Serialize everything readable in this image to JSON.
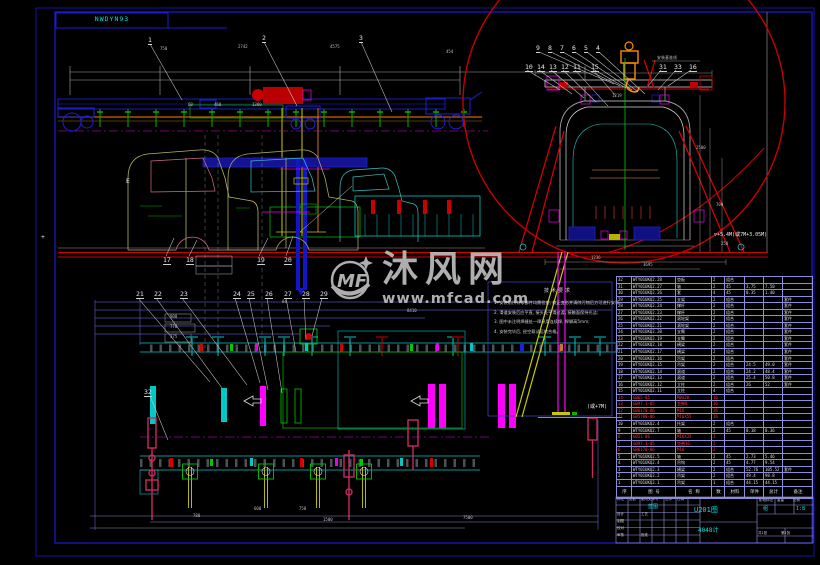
{
  "page": {
    "frame_label": "NWDYN93",
    "background": "#000000",
    "frame_color": "#1414c8"
  },
  "watermark": {
    "logo_text": "MF",
    "site_name": "沐风网",
    "site_url": "www.mfcad.com"
  },
  "notes": {
    "title": "技术要求",
    "items": [
      "1. 安装前所有零部件均需检查, 校正变形并清除污物后方可进行安装;",
      "2. 滑道安装后应平直, 接头处平滑过渡, 接触面保持光洁;",
      "3. 图中未注明焊缝处一律采用连续焊, 焊脚高5mm;",
      "4. 安装完毕后, 经空载试运转合格。"
    ]
  },
  "title_block": {
    "drawing_no": "U201图",
    "project": "4048计",
    "blueprint": "蓝图",
    "group": "组",
    "scale": "1:8"
  },
  "annotations": [
    {
      "t": "1",
      "x": 148,
      "y": 37,
      "c": "co"
    },
    {
      "t": "2",
      "x": 262,
      "y": 35,
      "c": "co"
    },
    {
      "t": "3",
      "x": 359,
      "y": 35,
      "c": "co"
    },
    {
      "t": "750",
      "x": 160,
      "y": 47,
      "c": "dim"
    },
    {
      "t": "2742",
      "x": 238,
      "y": 45,
      "c": "dim"
    },
    {
      "t": "4575",
      "x": 330,
      "y": 45,
      "c": "dim"
    },
    {
      "t": "454",
      "x": 446,
      "y": 50,
      "c": "dim"
    },
    {
      "t": "60",
      "x": 188,
      "y": 103,
      "c": "dim"
    },
    {
      "t": "460",
      "x": 214,
      "y": 103,
      "c": "dim"
    },
    {
      "t": "1380",
      "x": 252,
      "y": 103,
      "c": "dim"
    },
    {
      "t": "E",
      "x": 126,
      "y": 178,
      "c": "lab"
    },
    {
      "t": "+",
      "x": 41,
      "y": 234,
      "c": "lab"
    },
    {
      "t": "17",
      "x": 163,
      "y": 257,
      "c": "co"
    },
    {
      "t": "18",
      "x": 186,
      "y": 257,
      "c": "co"
    },
    {
      "t": "19",
      "x": 257,
      "y": 257,
      "c": "co"
    },
    {
      "t": "20",
      "x": 284,
      "y": 257,
      "c": "co"
    },
    {
      "t": "21",
      "x": 136,
      "y": 291,
      "c": "co"
    },
    {
      "t": "22",
      "x": 154,
      "y": 291,
      "c": "co"
    },
    {
      "t": "23",
      "x": 180,
      "y": 291,
      "c": "co"
    },
    {
      "t": "24",
      "x": 233,
      "y": 291,
      "c": "co"
    },
    {
      "t": "25",
      "x": 247,
      "y": 291,
      "c": "co"
    },
    {
      "t": "26",
      "x": 265,
      "y": 291,
      "c": "co"
    },
    {
      "t": "27",
      "x": 284,
      "y": 291,
      "c": "co"
    },
    {
      "t": "28",
      "x": 302,
      "y": 291,
      "c": "co"
    },
    {
      "t": "29",
      "x": 320,
      "y": 291,
      "c": "co"
    },
    {
      "t": "32",
      "x": 144,
      "y": 389,
      "c": "co"
    },
    {
      "t": "84",
      "x": 282,
      "y": 300,
      "c": "dim"
    },
    {
      "t": "8410",
      "x": 407,
      "y": 309,
      "c": "dim"
    },
    {
      "t": "900",
      "x": 170,
      "y": 315,
      "c": "dim"
    },
    {
      "t": "770",
      "x": 170,
      "y": 325,
      "c": "dim"
    },
    {
      "t": "375",
      "x": 170,
      "y": 335,
      "c": "dim"
    },
    {
      "t": "600",
      "x": 254,
      "y": 507,
      "c": "dim"
    },
    {
      "t": "750",
      "x": 299,
      "y": 507,
      "c": "dim"
    },
    {
      "t": "780",
      "x": 193,
      "y": 514,
      "c": "dim"
    },
    {
      "t": "1500",
      "x": 323,
      "y": 518,
      "c": "dim"
    },
    {
      "t": "7500",
      "x": 463,
      "y": 516,
      "c": "dim"
    },
    {
      "t": "9",
      "x": 536,
      "y": 45,
      "c": "co"
    },
    {
      "t": "8",
      "x": 548,
      "y": 45,
      "c": "co"
    },
    {
      "t": "7",
      "x": 560,
      "y": 45,
      "c": "co"
    },
    {
      "t": "6",
      "x": 572,
      "y": 45,
      "c": "co"
    },
    {
      "t": "5",
      "x": 584,
      "y": 45,
      "c": "co"
    },
    {
      "t": "4",
      "x": 596,
      "y": 45,
      "c": "co"
    },
    {
      "t": "10",
      "x": 525,
      "y": 64,
      "c": "co"
    },
    {
      "t": "14",
      "x": 537,
      "y": 64,
      "c": "co"
    },
    {
      "t": "13",
      "x": 549,
      "y": 64,
      "c": "co"
    },
    {
      "t": "12",
      "x": 561,
      "y": 64,
      "c": "co"
    },
    {
      "t": "11",
      "x": 573,
      "y": 64,
      "c": "co"
    },
    {
      "t": "15",
      "x": 591,
      "y": 64,
      "c": "co"
    },
    {
      "t": "31",
      "x": 659,
      "y": 64,
      "c": "co"
    },
    {
      "t": "33",
      "x": 674,
      "y": 64,
      "c": "co"
    },
    {
      "t": "16",
      "x": 689,
      "y": 64,
      "c": "co"
    },
    {
      "t": "1219",
      "x": 612,
      "y": 94,
      "c": "dim"
    },
    {
      "t": "2500",
      "x": 696,
      "y": 146,
      "c": "dim"
    },
    {
      "t": "700",
      "x": 716,
      "y": 203,
      "c": "dim"
    },
    {
      "t": "250",
      "x": 721,
      "y": 242,
      "c": "dim"
    },
    {
      "t": "1236",
      "x": 591,
      "y": 256,
      "c": "dim"
    },
    {
      "t": "3695",
      "x": 643,
      "y": 263,
      "c": "dim"
    },
    {
      "t": "安装基准线",
      "x": 657,
      "y": 56,
      "c": "dim"
    },
    {
      "t": "▽+5.4M(或7M+3.05M)",
      "x": 714,
      "y": 233,
      "c": "elev"
    },
    {
      "t": "(或+7M)",
      "x": 587,
      "y": 405,
      "c": "elev"
    },
    {
      "t": "标记",
      "x": 617,
      "y": 498,
      "c": "tbw"
    },
    {
      "t": "处数",
      "x": 629,
      "y": 498,
      "c": "tbw"
    },
    {
      "t": "更改文件号",
      "x": 641,
      "y": 498,
      "c": "tbw"
    },
    {
      "t": "签字",
      "x": 665,
      "y": 498,
      "c": "tbw"
    },
    {
      "t": "日期",
      "x": 677,
      "y": 498,
      "c": "tbw"
    },
    {
      "t": "设计",
      "x": 617,
      "y": 513,
      "c": "tbw"
    },
    {
      "t": "制图",
      "x": 617,
      "y": 520,
      "c": "tbw"
    },
    {
      "t": "校对",
      "x": 617,
      "y": 527,
      "c": "tbw"
    },
    {
      "t": "审核",
      "x": 617,
      "y": 534,
      "c": "tbw"
    },
    {
      "t": "工艺",
      "x": 641,
      "y": 513,
      "c": "tbw"
    },
    {
      "t": "批准",
      "x": 641,
      "y": 534,
      "c": "tbw"
    },
    {
      "t": "阶段标记",
      "x": 759,
      "y": 499,
      "c": "tbw"
    },
    {
      "t": "重量",
      "x": 777,
      "y": 499,
      "c": "tbw"
    },
    {
      "t": "比例",
      "x": 793,
      "y": 499,
      "c": "tbw"
    },
    {
      "t": "共1张",
      "x": 758,
      "y": 532,
      "c": "tbw"
    },
    {
      "t": "第1张",
      "x": 781,
      "y": 532,
      "c": "tbw"
    }
  ],
  "parts_table": {
    "header": [
      "序",
      "图 号",
      "名 称",
      "数",
      "材料",
      "单件",
      "总计",
      "备注"
    ],
    "rows": [
      {
        "red": false,
        "c": [
          "32",
          "WTY01UKQ2.28",
          "垫板",
          "2",
          "组合",
          "",
          "",
          ""
        ]
      },
      {
        "red": false,
        "c": [
          "31",
          "WTY01UKQ2.27",
          "轴",
          "2",
          "45",
          "3.75",
          "7.50",
          ""
        ]
      },
      {
        "red": false,
        "c": [
          "30",
          "WTY01UKQ2.26",
          "套",
          "4",
          "45",
          "0.35",
          "1.40",
          ""
        ]
      },
      {
        "red": false,
        "c": [
          "29",
          "WTY01UKQ2.25",
          "支架",
          "2",
          "组合",
          "",
          "",
          "套件"
        ]
      },
      {
        "red": false,
        "c": [
          "28",
          "WTY01UKQ2.24",
          "撑杆",
          "2",
          "组合",
          "",
          "",
          "套件"
        ]
      },
      {
        "red": false,
        "c": [
          "27",
          "WTY01UKQ2.23",
          "撑杆",
          "2",
          "组合",
          "",
          "",
          "套件"
        ]
      },
      {
        "red": false,
        "c": [
          "26",
          "WTY01UKQ2.22",
          "滚轮架",
          "2",
          "组合",
          "",
          "",
          "套件"
        ]
      },
      {
        "red": false,
        "c": [
          "25",
          "WTY01UKQ2.21",
          "滚轮架",
          "2",
          "组合",
          "",
          "",
          "套件"
        ]
      },
      {
        "red": false,
        "c": [
          "24",
          "WTY01UKQ2.20",
          "支臂",
          "2",
          "组合",
          "",
          "",
          "套件"
        ]
      },
      {
        "red": false,
        "c": [
          "23",
          "WTY01UKQ2.19",
          "支臂",
          "2",
          "组合",
          "",
          "",
          "套件"
        ]
      },
      {
        "red": false,
        "c": [
          "22",
          "WTY01UKQ2.18",
          "横梁",
          "2",
          "组合",
          "",
          "",
          "套件"
        ]
      },
      {
        "red": false,
        "c": [
          "21",
          "WTY01UKQ2.17",
          "横梁",
          "2",
          "组合",
          "",
          "",
          "套件"
        ]
      },
      {
        "red": false,
        "c": [
          "20",
          "WTY01UKQ2.16",
          "吊架",
          "2",
          "组合",
          "",
          "",
          "套件"
        ]
      },
      {
        "red": false,
        "c": [
          "19",
          "WTY01UKQ2.15",
          "吊架",
          "2",
          "组合",
          "24.5",
          "49.0",
          "套件"
        ]
      },
      {
        "red": false,
        "c": [
          "18",
          "WTY01UKQ2.14",
          "滚道",
          "2",
          "组合",
          "24.2",
          "48.4",
          "套件"
        ]
      },
      {
        "red": false,
        "c": [
          "17",
          "WTY01UKQ2.13",
          "滚道",
          "2",
          "组合",
          "25.4",
          "50.8",
          "套件"
        ]
      },
      {
        "red": false,
        "c": [
          "16",
          "WTY01UKQ2.12",
          "立柱",
          "2",
          "组合",
          "26",
          "52",
          "套件"
        ]
      },
      {
        "red": false,
        "c": [
          "15",
          "WTY01UKQ2.11",
          "立柱",
          "4",
          "组合",
          "",
          "",
          ""
        ]
      },
      {
        "red": true,
        "c": [
          "14",
          "GB65-85",
          "M8X20",
          "16",
          "",
          "",
          "",
          ""
        ]
      },
      {
        "red": true,
        "c": [
          "13",
          "GB97.1-85",
          "垫圈8",
          "16",
          "",
          "",
          "",
          ""
        ]
      },
      {
        "red": true,
        "c": [
          "12",
          "GB6170-86",
          "M16",
          "16",
          "",
          "",
          "",
          ""
        ]
      },
      {
        "red": true,
        "c": [
          "11",
          "GB5780-86",
          "M16X55",
          "16",
          "",
          "",
          "",
          ""
        ]
      },
      {
        "red": false,
        "c": [
          "10",
          "WTY01UKQ2.4",
          "托架",
          "2",
          "组合",
          "",
          "",
          ""
        ]
      },
      {
        "red": false,
        "c": [
          "9",
          "WTY01UKQ2.7",
          "轴",
          "2",
          "45",
          "0.18",
          "0.36",
          ""
        ]
      },
      {
        "red": true,
        "c": [
          "8",
          "GB51-86",
          "M16X35",
          "2",
          "",
          "",
          "",
          ""
        ]
      },
      {
        "red": true,
        "c": [
          "7",
          "GB97.1-85",
          "垫圈16",
          "2",
          "",
          "",
          "",
          ""
        ]
      },
      {
        "red": true,
        "c": [
          "6",
          "GB6170-86",
          "M16",
          "2",
          "",
          "",
          "",
          ""
        ]
      },
      {
        "red": false,
        "c": [
          "5",
          "WTY01UKQ2.5",
          "轴",
          "2",
          "45",
          "2.73",
          "5.46",
          ""
        ]
      },
      {
        "red": false,
        "c": [
          "4",
          "WTY01UKQ2.4",
          "吊钩",
          "2",
          "45",
          "4.77",
          "9.54",
          ""
        ]
      },
      {
        "red": false,
        "c": [
          "3",
          "WTY01UKQ2.3",
          "横梁",
          "2",
          "组合",
          "52.76",
          "105.52",
          "套件"
        ]
      },
      {
        "red": false,
        "c": [
          "2",
          "WTY01UKQ2.2",
          "吊架",
          "2",
          "组合",
          "49.4",
          "98.8",
          ""
        ]
      },
      {
        "red": false,
        "c": [
          "1",
          "WTY01UKQ2.1",
          "吊架",
          "1",
          "组合",
          "44.15",
          "44.15",
          ""
        ]
      }
    ]
  }
}
